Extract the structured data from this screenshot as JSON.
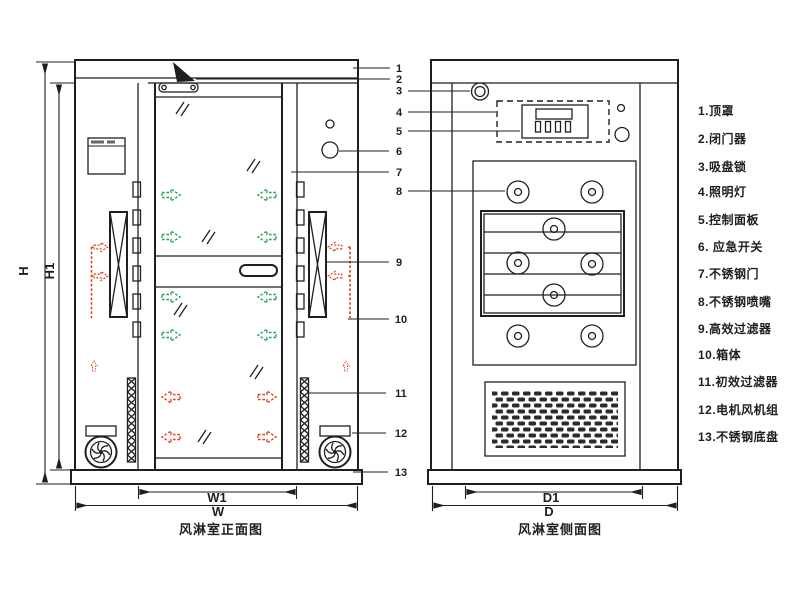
{
  "captions": {
    "front": "风淋室正面图",
    "side": "风淋室侧面图"
  },
  "dims": {
    "H": "H",
    "H1": "H1",
    "W": "W",
    "W1": "W1",
    "D": "D",
    "D1": "D1"
  },
  "callouts": {
    "numbers": [
      "1",
      "2",
      "3",
      "4",
      "5",
      "6",
      "7",
      "8",
      "9",
      "10",
      "11",
      "12",
      "13"
    ]
  },
  "legend": {
    "items": [
      "1.顶罩",
      "2.闭门器",
      "3.吸盘锁",
      "4.照明灯",
      "5.控制面板",
      "6. 应急开关",
      "7.不锈钢门",
      "8.不锈钢喷嘴",
      "9.高效过滤器",
      "10.箱体",
      "11.初效过滤器",
      "12.电机风机组",
      "13.不锈钢底盘"
    ]
  },
  "colors": {
    "line": "#1f1f1f",
    "green_arrow": "#2aa05a",
    "red_arrow": "#e2401f",
    "background": "#ffffff"
  }
}
